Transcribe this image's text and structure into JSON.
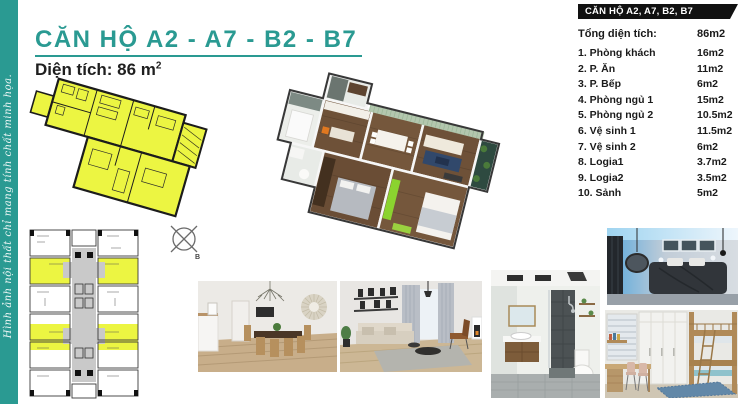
{
  "page": {
    "title": "CĂN HỘ  A2 - A7 - B2 - B7",
    "subtitle_prefix": "Diện tích: 86 m",
    "subtitle_sup": "2",
    "side_note": "Hình ảnh nội thất chỉ mang tính chất minh họa.",
    "colors": {
      "accent_teal": "#2a9a92",
      "plan_yellow": "#ecf542",
      "table_header_bg": "#111111",
      "wood_floor": "#6e5138",
      "accent_wall_green": "#b3c7ae",
      "wardrobe_bright_green": "#8bd32f"
    }
  },
  "info_table": {
    "header": "CĂN HỘ A2, A7, B2, B7",
    "total": {
      "label": "Tổng diện tích:",
      "value": "86m2"
    },
    "rows": [
      {
        "label": "1. Phòng khách",
        "value": "16m2"
      },
      {
        "label": "2. P. Ăn",
        "value": "11m2"
      },
      {
        "label": "3. P. Bếp",
        "value": "6m2"
      },
      {
        "label": "4. Phòng ngủ 1",
        "value": "15m2"
      },
      {
        "label": "5. Phòng ngủ 2",
        "value": "10.5m2"
      },
      {
        "label": "6. Vệ sinh 1",
        "value": "11.5m2"
      },
      {
        "label": "7. Vệ sinh 2",
        "value": "6m2"
      },
      {
        "label": "8. Logia1",
        "value": "3.7m2"
      },
      {
        "label": "9. Logia2",
        "value": "3.5m2"
      },
      {
        "label": "10. Sảnh",
        "value": "5m2"
      }
    ]
  },
  "compass": {
    "label": "B"
  },
  "figures": {
    "floor_plan_2d": "unit floor plan (yellow)",
    "key_plan": "building key plan with highlighted units",
    "floor_plan_3d": "3D isometric apartment render",
    "photos": [
      {
        "name": "dining-room"
      },
      {
        "name": "living-room"
      },
      {
        "name": "bathroom"
      },
      {
        "name": "master-bedroom"
      },
      {
        "name": "kids-bedroom"
      }
    ]
  }
}
